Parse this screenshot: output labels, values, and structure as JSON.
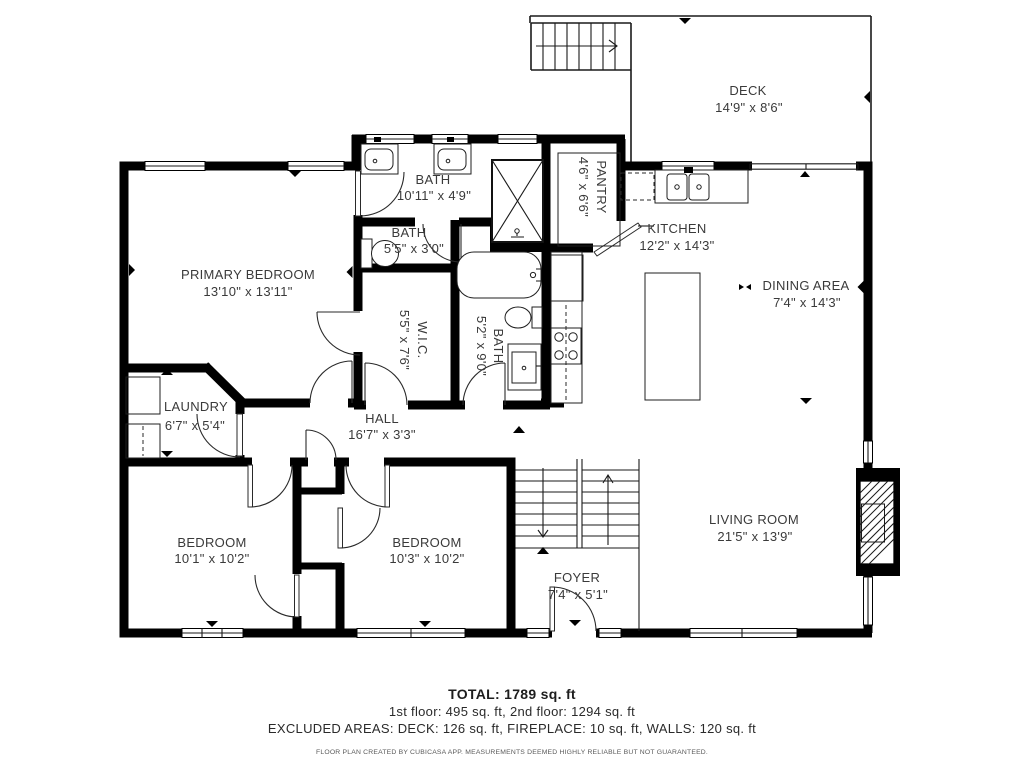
{
  "meta": {
    "bg_color": "#ffffff",
    "wall_color": "#000000",
    "text_color": "#3a3a3a"
  },
  "rooms": {
    "deck": {
      "name": "DECK",
      "dims": "14'9\" x 8'6\""
    },
    "bath_main": {
      "name": "BATH",
      "dims": "10'11\" x 4'9\""
    },
    "pantry": {
      "name": "PANTRY",
      "dims": "4'6\" x 6'6\""
    },
    "kitchen": {
      "name": "KITCHEN",
      "dims": "12'2\" x 14'3\""
    },
    "dining": {
      "name": "DINING AREA",
      "dims": "7'4\" x 14'3\""
    },
    "primary_bedroom": {
      "name": "PRIMARY BEDROOM",
      "dims": "13'10\" x 13'11\""
    },
    "bath_small": {
      "name": "BATH",
      "dims": "5'5\" x 3'0\""
    },
    "wic": {
      "name": "W.I.C.",
      "dims": "5'5\" x 7'6\""
    },
    "bath_hall": {
      "name": "BATH",
      "dims": "5'2\" x 9'0\""
    },
    "laundry": {
      "name": "LAUNDRY",
      "dims": "6'7\" x 5'4\""
    },
    "hall": {
      "name": "HALL",
      "dims": "16'7\" x 3'3\""
    },
    "bedroom_left": {
      "name": "BEDROOM",
      "dims": "10'1\" x 10'2\""
    },
    "bedroom_right": {
      "name": "BEDROOM",
      "dims": "10'3\" x 10'2\""
    },
    "foyer": {
      "name": "FOYER",
      "dims": "7'4\" x 5'1\""
    },
    "living": {
      "name": "LIVING ROOM",
      "dims": "21'5\" x 13'9\""
    }
  },
  "summary": {
    "total": "TOTAL: 1789 sq. ft",
    "floors": "1st floor: 495 sq. ft, 2nd floor: 1294 sq. ft",
    "excluded": "EXCLUDED AREAS: DECK: 126 sq. ft, FIREPLACE: 10 sq. ft, WALLS: 120 sq. ft",
    "disclaimer": "FLOOR PLAN CREATED BY CUBICASA APP. MEASUREMENTS DEEMED HIGHLY RELIABLE BUT NOT GUARANTEED."
  }
}
